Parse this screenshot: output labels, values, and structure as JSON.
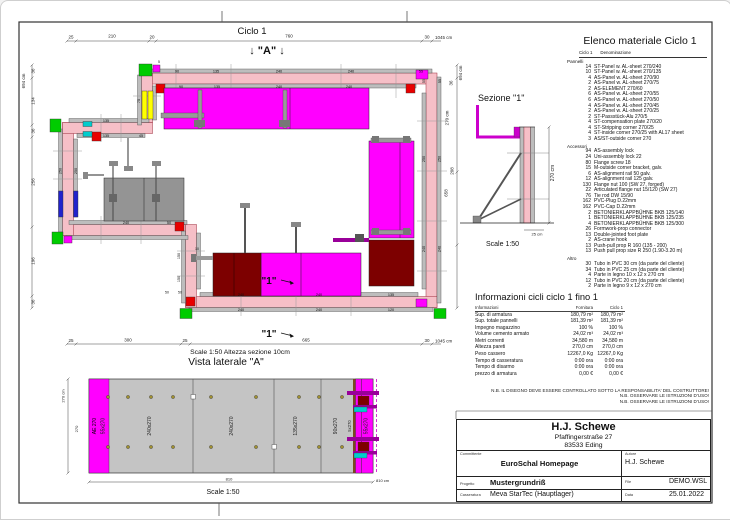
{
  "colors": {
    "wall_pink": "#f6bfc7",
    "panel_gray": "#bdbdbd",
    "platform_magenta": "#ff00ff",
    "platform_dark_red": "#7d0000",
    "platform_gray": "#949494",
    "accent_yellow": "#ffff00",
    "corner_green": "#00cc00",
    "corner_red": "#e80000",
    "accent_blue": "#2222cc",
    "accent_cyan": "#00cccc",
    "accent_purple": "#990099"
  },
  "plan": {
    "title": "Ciclo 1",
    "marker_a": "↓ \"A\" ↓",
    "marker_1": "\"1\"",
    "scale_note": "Scale 1:50   Altezza sezione 10cm",
    "dims": {
      "top": [
        "25",
        "210",
        "20",
        "760",
        "30",
        "1045 cm"
      ],
      "bottom": [
        "25",
        "300",
        "25",
        "665",
        "30",
        "1045 cm"
      ],
      "left": [
        "694 cm",
        "36",
        "134",
        "36",
        "256",
        "196",
        "36"
      ],
      "right": [
        "694 cm",
        "36",
        "270 cm",
        "208",
        "658"
      ]
    },
    "wall_labels": {
      "top_outer": [
        "90",
        "135",
        "240",
        "240",
        "55"
      ],
      "top_inner": [
        "90",
        "135",
        "240",
        "240"
      ],
      "right_outer": [
        "250",
        "240"
      ],
      "right_inner": [
        "250",
        "240"
      ],
      "left": [
        "250",
        "250"
      ],
      "g_wall": [
        "135",
        "135",
        "45"
      ],
      "e_wall": [
        "240",
        "50"
      ],
      "c_inner": [
        "240",
        "240",
        "135"
      ],
      "c_outer": [
        "240",
        "240",
        "120"
      ],
      "h_wall": [
        "75"
      ],
      "b_top": [
        "55",
        "55"
      ],
      "d_wall": [
        "150",
        "150"
      ],
      "misc": [
        "50",
        "50",
        "10",
        "5"
      ]
    }
  },
  "section": {
    "title": "Sezione \"1\"",
    "dim_h": "270 cm",
    "dim_b": "25 cm",
    "scale": "Scale 1:50"
  },
  "materials": {
    "title": "Elenco materiale  Ciclo 1",
    "col1": "Ciclo 1",
    "col2": "Denominazione",
    "group_panels": "Pannelli",
    "group_accessories": "Accessori",
    "group_other": "Altro",
    "panels": [
      {
        "qty": "14",
        "name": "ST-Panel w. AL-sheet  270/240"
      },
      {
        "qty": "10",
        "name": "ST-Panel w. AL-sheet  270/135"
      },
      {
        "qty": "4",
        "name": "AS-Panel w. AL-sheet  270/90"
      },
      {
        "qty": "2",
        "name": "AS-Panel w. AL-sheet  270/75"
      },
      {
        "qty": "2",
        "name": "AS-ELEMENT  270/60"
      },
      {
        "qty": "6",
        "name": "AS-Panel w. AL-sheet  270/55"
      },
      {
        "qty": "6",
        "name": "AS-Panel w. AL-sheet  270/50"
      },
      {
        "qty": "4",
        "name": "AS-Panel w. AL-sheet  270/45"
      },
      {
        "qty": "2",
        "name": "AS-Panel w. AL-sheet  270/25"
      },
      {
        "qty": "2",
        "name": "ST-Passstück-Alu  270/5"
      },
      {
        "qty": "4",
        "name": "ST-compensation plate  270/20"
      },
      {
        "qty": "4",
        "name": "ST-Stripping corner 270/25"
      },
      {
        "qty": "4",
        "name": "ST-inside corner 270/25 with AL17 sheet"
      },
      {
        "qty": "3",
        "name": "AS/ST-outside corner  270"
      }
    ],
    "accessories": [
      {
        "qty": "94",
        "name": "AS-assembly lock"
      },
      {
        "qty": "24",
        "name": "Uni-assembly lock  22"
      },
      {
        "qty": "80",
        "name": "Flange screw 18"
      },
      {
        "qty": "15",
        "name": "M-outside corner bracket, galv."
      },
      {
        "qty": "6",
        "name": "AS-alignment rail 50  galv."
      },
      {
        "qty": "12",
        "name": "AS-alignment rail 125  galv."
      },
      {
        "qty": "130",
        "name": "Flange nut 100 (SW 27, forged)"
      },
      {
        "qty": "22",
        "name": "Articulated flange nut 15/120 (SW 27)"
      },
      {
        "qty": "76",
        "name": "Tie rod DW 15/90"
      },
      {
        "qty": "162",
        "name": "PVC-Plug D.22mm"
      },
      {
        "qty": "162",
        "name": "PVC-Cap D.22mm"
      },
      {
        "qty": "2",
        "name": "BETONIERKLAPPBÜHNE BKB 125/140"
      },
      {
        "qty": "1",
        "name": "BETONIERKLAPPBÜHNE BKB 125/235"
      },
      {
        "qty": "4",
        "name": "BETONIERKLAPPBÜHNE BKB 125/300"
      },
      {
        "qty": "26",
        "name": "Formwork-prop connector"
      },
      {
        "qty": "13",
        "name": "Double-jointed foot plate"
      },
      {
        "qty": "2",
        "name": "AS-crane hook"
      },
      {
        "qty": "13",
        "name": "Push-pull prop R 160 (135 - 200)"
      },
      {
        "qty": "13",
        "name": "Push pull prop size R 250  (1.90-3.20 m)"
      }
    ],
    "other": [
      {
        "qty": "30",
        "name": "Tubo in PVC 30 cm (da parte del cliente)"
      },
      {
        "qty": "34",
        "name": "Tubo in PVC 25 cm (da parte del cliente)"
      },
      {
        "qty": "4",
        "name": "Parte in legno 10 x 12 x 270 cm"
      },
      {
        "qty": "12",
        "name": "Tubo in PVC 20 cm (da parte del cliente)"
      },
      {
        "qty": "2",
        "name": "Parte in legno 9 x 12 x 270 cm"
      }
    ]
  },
  "info": {
    "title": "Informazioni cicli  ciclo 1 fino 1",
    "col_info": "Informazioni",
    "col_forn": "Fornitura",
    "col_ciclo": "Ciclo 1",
    "rows": [
      {
        "label": "Sup. di armatura",
        "forn": "180,79 m²",
        "ciclo": "180,79 m²"
      },
      {
        "label": "Sup. totale pannelli",
        "forn": "181,39 m²",
        "ciclo": "181,39 m²"
      },
      {
        "label": "Impegno magazzino",
        "forn": "100 %",
        "ciclo": "100 %"
      },
      {
        "label": "Volume cemento armato",
        "forn": "24,02 m³",
        "ciclo": "24,02 m³"
      },
      {
        "label": "Metri correnti",
        "forn": "34,580 m",
        "ciclo": "34,580 m"
      },
      {
        "label": "Altezza pareti",
        "forn": "270,0 cm",
        "ciclo": "270,0 cm"
      },
      {
        "label": "Peso cassero",
        "forn": "12267,0 Kg",
        "ciclo": "12267,0 Kg"
      },
      {
        "label": "Tempo di casseratura",
        "forn": "0:00 ora",
        "ciclo": "0:00 ora"
      },
      {
        "label": "Tempo di disarmo",
        "forn": "0:00 ora",
        "ciclo": "0:00 ora"
      },
      {
        "label": "prezzo di armatura",
        "forn": "0,00 €",
        "ciclo": "0,00 €"
      }
    ]
  },
  "notes": [
    "N.B. IL DISEGNO DEVE ESSERE CONTROLLATO SOTTO LA RESPONSABILITA' DEL COSTRUTTORE!",
    "N.B. OSSERVARE LE ISTRUZIONI D'USO!",
    "N.B. OSSERVARE LE ISTRUZIONI D'USO!"
  ],
  "lateral": {
    "title": "Vista laterale \"A\"",
    "panels": [
      "AE 270",
      "55x270",
      "240x270",
      "240x270",
      "135x270",
      "90x270",
      "5x270",
      "55x270"
    ],
    "dim_total": "810",
    "dim_total_unit": "810 cm",
    "dim_h": "270 cm",
    "dim_h2": "270",
    "scale": "Scale 1:50"
  },
  "titleblock": {
    "company": "H.J. Schewe",
    "address1": "Pfaffingerstraße 27",
    "address2": "83533 Eding",
    "committente_label": "Committente",
    "committente": "EuroSchal Homepage",
    "autore_label": "Autore",
    "autore": "H.J. Schewe",
    "progetto_label": "Progetto",
    "progetto": "Mustergrundriß",
    "file_label": "File",
    "file": "DEMO.WSL",
    "casseratura_label": "Casseratura",
    "casseratura": "Meva StarTec (Hauptlager)",
    "data_label": "Data",
    "data": "25.01.2022"
  }
}
